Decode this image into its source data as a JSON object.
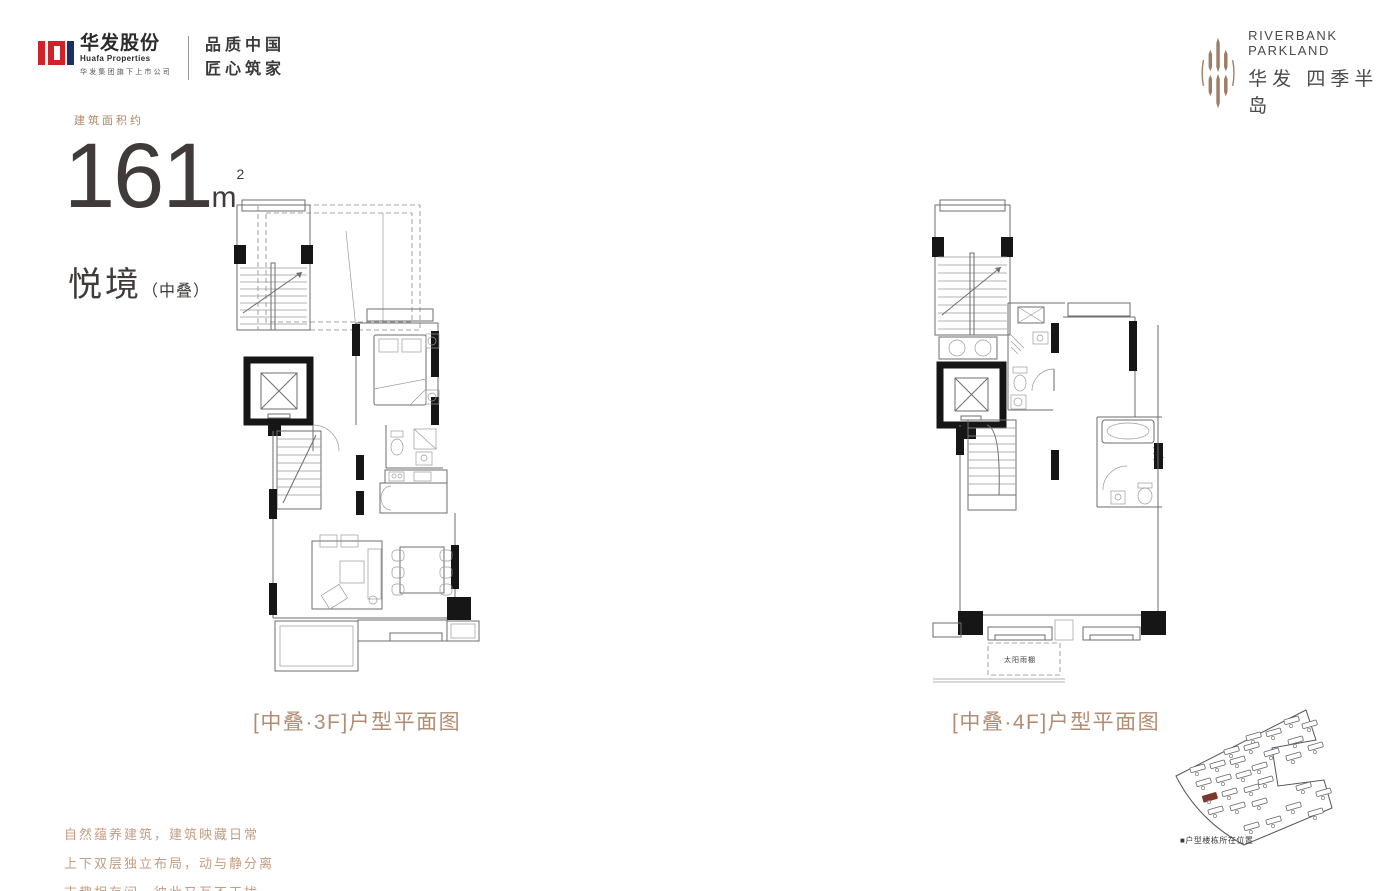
{
  "header": {
    "huafa_logo": {
      "name_cn": "华发股份",
      "name_en": "Huafa Properties",
      "subtitle": "华发集团旗下上市公司",
      "slogan_line1": "品质中国",
      "slogan_line2": "匠心筑家",
      "red": "#cf2229",
      "navy": "#1f2f5e"
    },
    "project_logo": {
      "name_en": "RIVERBANK PARKLAND",
      "name_cn": "华发 四季半岛",
      "brown": "#9c7d66"
    }
  },
  "title": {
    "area_prefix": "建筑面积约",
    "area_value": "161",
    "area_unit": "m",
    "area_sup": "2",
    "type_name": "悦境",
    "type_suffix": "（中叠）"
  },
  "plans": {
    "left_caption": "[中叠·3F]户型平面图",
    "right_caption": "[中叠·4F]户型平面图",
    "right_plan_annotation": "太阳雨棚",
    "caption_color": "#b28d73"
  },
  "siteplan": {
    "legend": "■户型楼栋所在位置",
    "highlight_color": "#7b392b"
  },
  "footer": {
    "color": "#c49e83",
    "line1": "自然蕴养建筑，建筑映藏日常",
    "line2": "上下双层独立布局，动与静分离",
    "line3": "志趣相存间，彼此又互不干扰"
  }
}
